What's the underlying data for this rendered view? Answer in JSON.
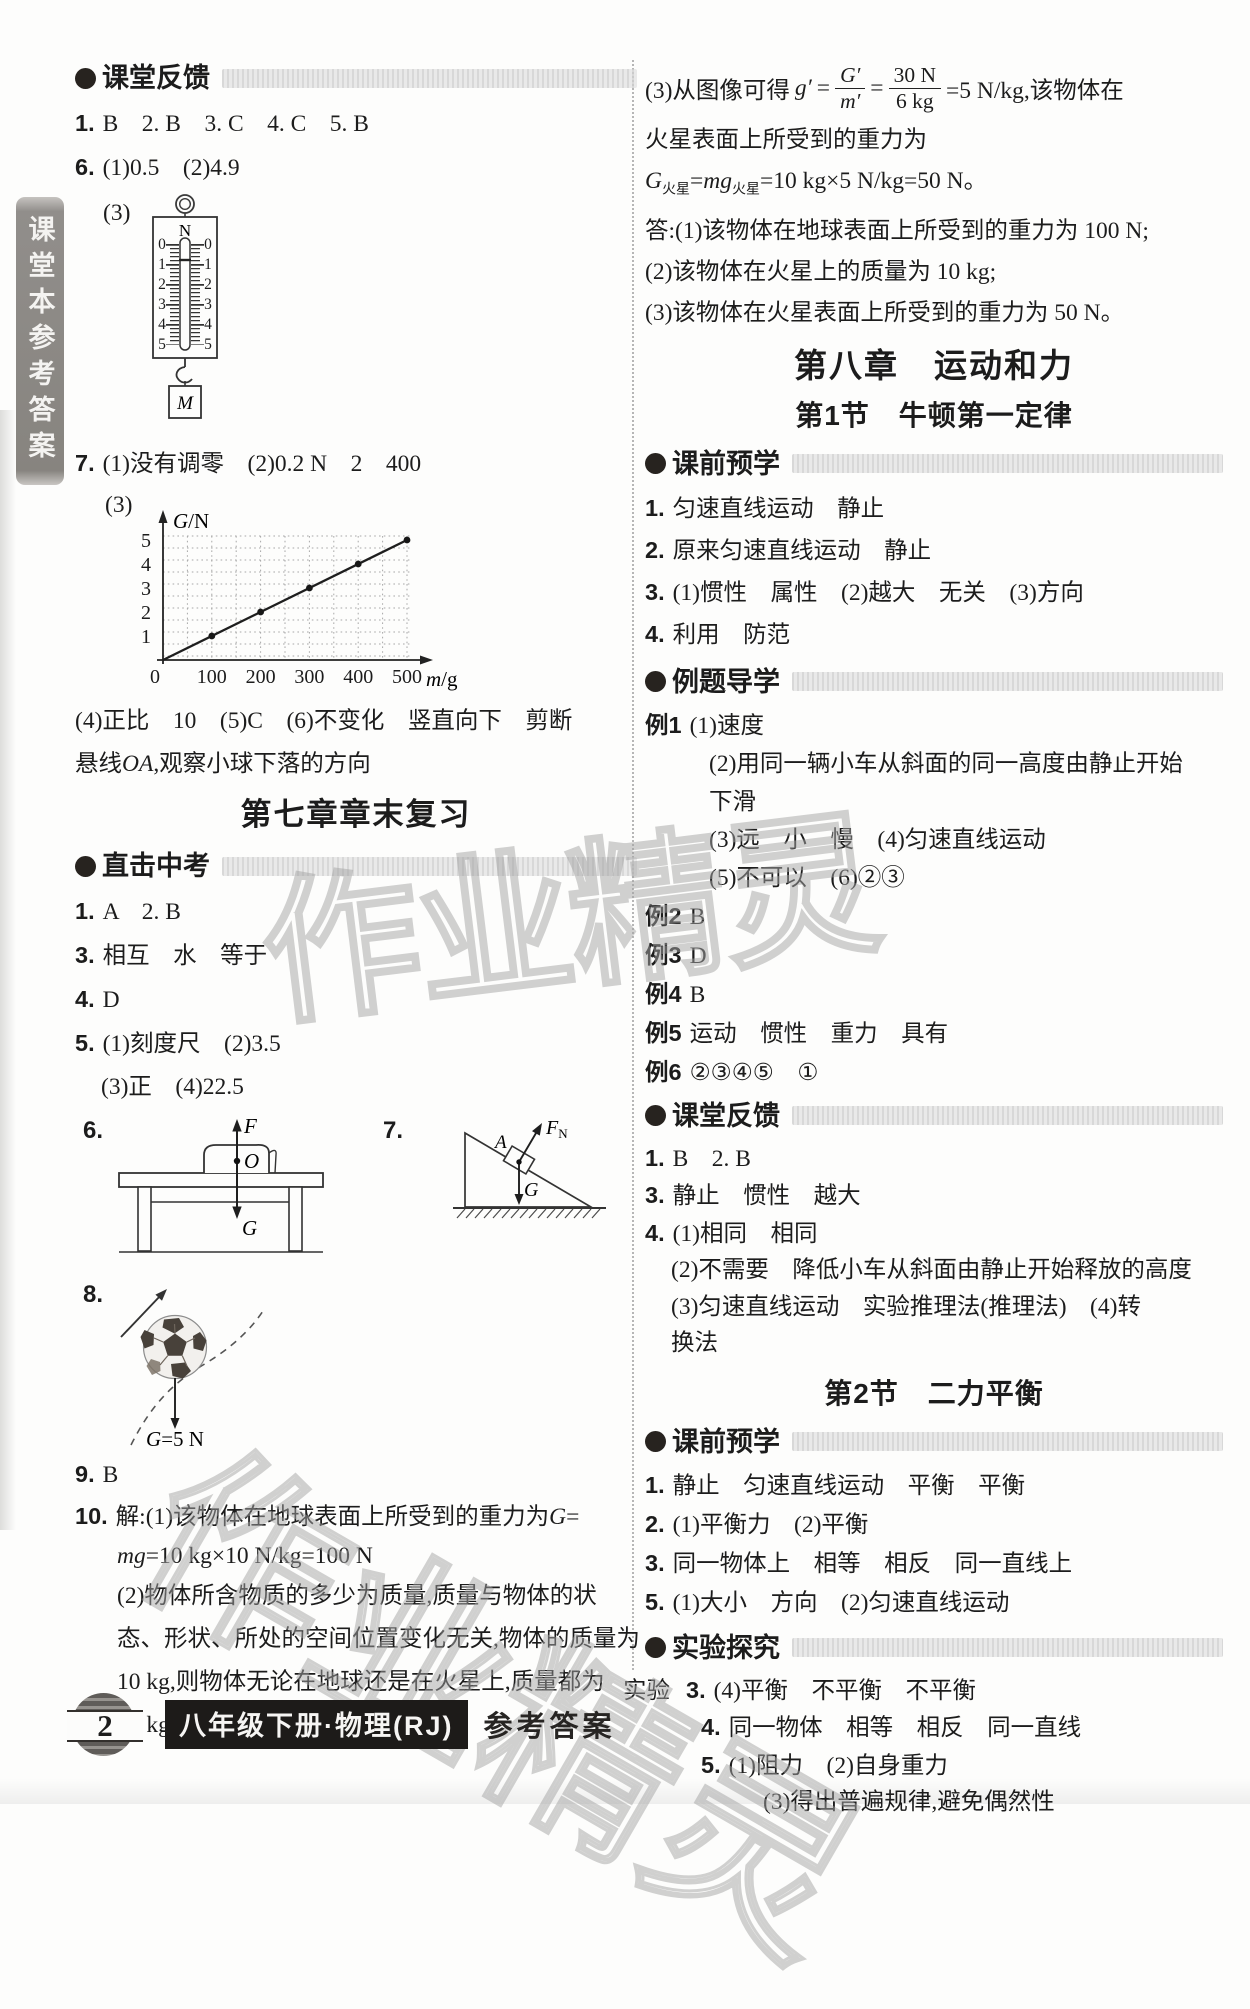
{
  "sidebar": {
    "label": "课堂本参考答案"
  },
  "watermark": {
    "text": "作业精灵"
  },
  "left": {
    "s1": {
      "title": "课堂反馈",
      "lines": [
        {
          "p": "1.",
          "t": "B　2. B　3. C　4. C　5. B"
        },
        {
          "p": "6.",
          "t": "(1)0.5　(2)4.9"
        }
      ],
      "spring": {
        "label": "(3)",
        "unit": "N",
        "ticks": [
          "0",
          "1",
          "2",
          "3",
          "4",
          "5"
        ],
        "weight": "M"
      },
      "lines7": [
        {
          "p": "7.",
          "t": "(1)没有调零　(2)0.2 N　2　400"
        }
      ],
      "graph": {
        "label": "(3)",
        "type": "line",
        "ylabel_var": "G",
        "ylabel_rest": "/N",
        "xlabel_var": "m",
        "xlabel_rest": "/g",
        "xticks": [
          "0",
          "100",
          "200",
          "300",
          "400",
          "500"
        ],
        "yticks": [
          "1",
          "2",
          "3",
          "4",
          "5"
        ],
        "points": [
          [
            100,
            1
          ],
          [
            200,
            2
          ],
          [
            300,
            3
          ],
          [
            400,
            4
          ],
          [
            500,
            5
          ]
        ]
      },
      "lines4": [
        {
          "t": "(4)正比　10　(5)C　(6)不变化　竖直向下　剪断"
        }
      ],
      "line_xa": {
        "pre": "悬线",
        "v": "OA",
        "post": ",观察小球下落的方向"
      }
    },
    "ch7_title": "第七章章末复习",
    "s2": {
      "title": "直击中考",
      "lines": [
        {
          "p": "1.",
          "t": "A　2. B"
        },
        {
          "p": "3.",
          "t": "相互　水　等于"
        },
        {
          "p": "4.",
          "t": "D"
        },
        {
          "p": "5.",
          "t": "(1)刻度尺　(2)3.5"
        },
        {
          "t": "(3)正　(4)22.5",
          "ind": 1
        }
      ],
      "fig6": {
        "num": "6.",
        "force_up": "F",
        "pivot": "O",
        "force_down": "G"
      },
      "fig7": {
        "num": "7.",
        "normal_var": "F",
        "normal_sub": "N",
        "block": "A",
        "gravity": "G"
      },
      "fig8": {
        "num": "8.",
        "g_var": "G",
        "g_rest": "=5 N"
      },
      "lines9": [
        {
          "p": "9.",
          "t": "B"
        }
      ],
      "item10": {
        "num": "10.",
        "pre": "解:(1)该物体在地球表面上所受到的重力为",
        "g": "G",
        "eq": "=",
        "mg": "mg",
        "mg_rest": "=10 kg×10 N/kg=100 N",
        "lines": [
          {
            "t": "(2)物体所含物质的多少为质量,质量与物体的状"
          },
          {
            "t": "态、形状、所处的空间位置变化无关,物体的质量为"
          },
          {
            "t": "10 kg,则物体无论在地球还是在火星上,质量都为"
          },
          {
            "t": "10 kg。"
          }
        ]
      }
    }
  },
  "right": {
    "f": {
      "label": "(3)从图像可得",
      "v": "g′",
      "eq1": "=",
      "n1": "G′",
      "d1": "m′",
      "eq2": "=",
      "n2": "30 N",
      "d2": "6 kg",
      "res": "=5 N/kg,该物体在"
    },
    "lines_top": [
      {
        "t": "火星表面上所受到的重力为"
      }
    ],
    "gw": {
      "v1": "G",
      "s1": "火星",
      "eq": "=",
      "v2": "mg",
      "s2": "火星",
      "rest": "=10 kg×5 N/kg=50 N。"
    },
    "lines_ans": [
      {
        "t": "答:(1)该物体在地球表面上所受到的重力为 100 N;"
      },
      {
        "t": "(2)该物体在火星上的质量为 10 kg;"
      },
      {
        "t": "(3)该物体在火星表面上所受到的重力为 50 N。"
      }
    ],
    "ch8_title": "第八章　运动和力",
    "sec1_title": "第1节　牛顿第一定律",
    "s1": {
      "title": "课前预学",
      "lines": [
        {
          "p": "1.",
          "t": "匀速直线运动　静止"
        },
        {
          "p": "2.",
          "t": "原来匀速直线运动　静止"
        },
        {
          "p": "3.",
          "t": "(1)惯性　属性　(2)越大　无关　(3)方向"
        },
        {
          "p": "4.",
          "t": "利用　防范"
        }
      ]
    },
    "s2": {
      "title": "例题导学",
      "lines": [
        {
          "p": "例1",
          "t": "(1)速度"
        },
        {
          "t": "(2)用同一辆小车从斜面的同一高度由静止开始",
          "ind": 2
        },
        {
          "t": "下滑",
          "ind": 2
        },
        {
          "t": "(3)远　小　慢　(4)匀速直线运动",
          "ind": 2
        },
        {
          "t": "(5)不可以　(6)②③",
          "ind": 2
        },
        {
          "p": "例2",
          "t": "B"
        },
        {
          "p": "例3",
          "t": "D"
        },
        {
          "p": "例4",
          "t": "B"
        },
        {
          "p": "例5",
          "t": "运动　惯性　重力　具有"
        },
        {
          "p": "例6",
          "t": "②③④⑤　①"
        }
      ]
    },
    "s3": {
      "title": "课堂反馈",
      "lines": [
        {
          "p": "1.",
          "t": "B　2. B"
        },
        {
          "p": "3.",
          "t": "静止　惯性　越大"
        },
        {
          "p": "4.",
          "t": "(1)相同　相同"
        },
        {
          "t": "(2)不需要　降低小车从斜面由静止开始释放的高度",
          "ind": 1
        },
        {
          "t": "(3)匀速直线运动　实验推理法(推理法)　(4)转",
          "ind": 1
        },
        {
          "t": "换法",
          "ind": 1
        }
      ]
    },
    "sec2_title": "第2节　二力平衡",
    "s4": {
      "title": "课前预学",
      "lines": [
        {
          "p": "1.",
          "t": "静止　匀速直线运动　平衡　平衡"
        },
        {
          "p": "2.",
          "t": "(1)平衡力　(2)平衡"
        },
        {
          "p": "3.",
          "t": "同一物体上　相等　相反　同一直线上"
        },
        {
          "p": "5.",
          "t": "(1)大小　方向　(2)匀速直线运动"
        }
      ]
    },
    "s5": {
      "title": "实验探究",
      "lines": [
        {
          "l": "实验",
          "p": "3.",
          "t": "(4)平衡　不平衡　不平衡",
          "h": 1
        },
        {
          "p": "4.",
          "t": "同一物体　相等　相反　同一直线",
          "ind": 3
        },
        {
          "p": "5.",
          "t": "(1)阻力　(2)自身重力",
          "ind": 3
        },
        {
          "t": "(3)得出普遍规律,避免偶然性",
          "ind": 4
        }
      ]
    }
  },
  "footer": {
    "page": "2",
    "book": "八年级下册·物理(RJ)",
    "ref": "参考答案"
  }
}
